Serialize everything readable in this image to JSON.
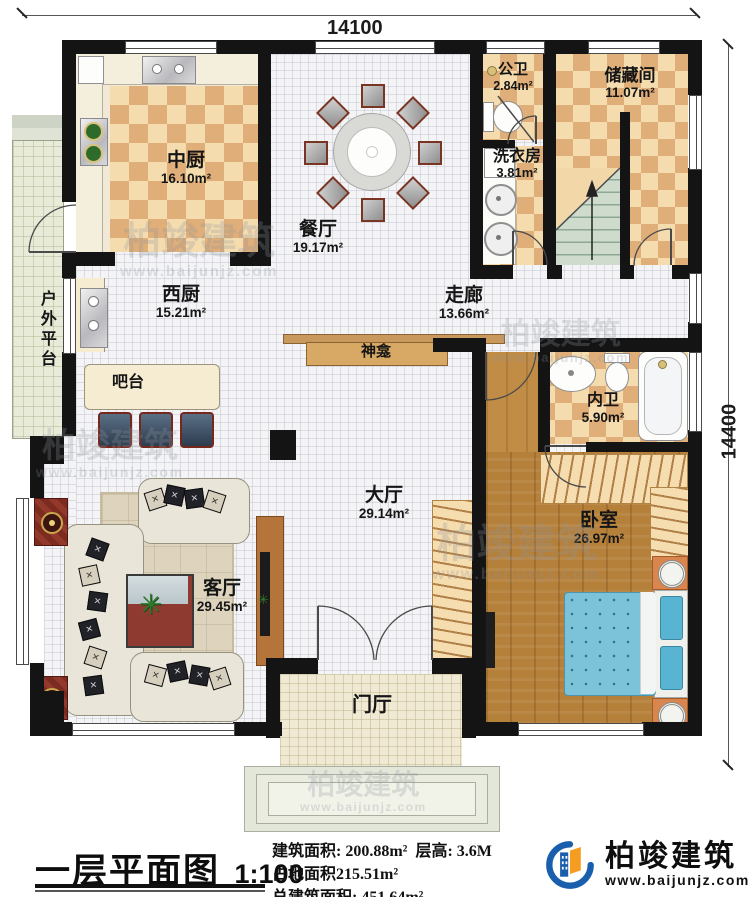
{
  "dimensions": {
    "top": "14100",
    "right": "14400"
  },
  "title_block": {
    "title": "一层平面图",
    "scale": "1:100"
  },
  "stats": {
    "line1": "建筑面积: 200.88m²",
    "height": "层高: 3.6M",
    "line2": "占地面积215.51m²",
    "line3": "总建筑面积: 451.64m²"
  },
  "logo": {
    "company": "柏竣建筑",
    "website": "www.baijunjz.com"
  },
  "watermark": {
    "brand": "柏竣建筑",
    "site": "www.baijunjz.com"
  },
  "rooms": {
    "zhongchu": {
      "name": "中厨",
      "area": "16.10m²"
    },
    "canting": {
      "name": "餐厅",
      "area": "19.17m²"
    },
    "gongwei": {
      "name": "公卫",
      "area": "2.84m²"
    },
    "chucangjian": {
      "name": "储藏间",
      "area": "11.07m²"
    },
    "xiyifang": {
      "name": "洗衣房",
      "area": "3.81m²"
    },
    "zoulang": {
      "name": "走廊",
      "area": "13.66m²"
    },
    "xichu": {
      "name": "西厨",
      "area": "15.21m²"
    },
    "batai": {
      "name": "吧台"
    },
    "shenkan": {
      "name": "神龛"
    },
    "neiwei": {
      "name": "内卫",
      "area": "5.90m²"
    },
    "woshi": {
      "name": "卧室",
      "area": "26.97m²"
    },
    "dating": {
      "name": "大厅",
      "area": "29.14m²"
    },
    "keting": {
      "name": "客厅",
      "area": "29.45m²"
    },
    "huwaipingtai": {
      "name": "户外平台"
    },
    "menting": {
      "name": "门厅"
    }
  }
}
